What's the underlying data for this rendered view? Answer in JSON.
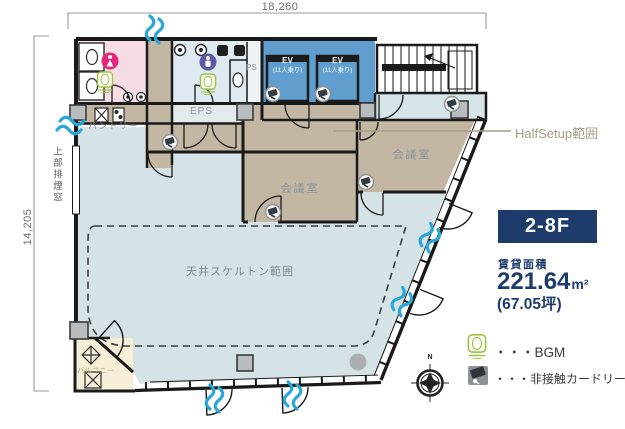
{
  "colors": {
    "accent_navy": "#1d3c6c",
    "halfsetup_tan": "#c3b7a4",
    "main_floor_blue": "#d6e3e6",
    "ev_blue": "#5f9ecf",
    "wc_women_pink": "#f6dde4",
    "wc_men_blue": "#dfeaf0",
    "eps_room": "#e2eaec",
    "hall_strip": "#d8e5e8",
    "balcony_cream": "#f6efd7",
    "airflow_blue": "#29a7d8",
    "bgm_green": "#9cc43e",
    "wall_black": "#1a1a1a"
  },
  "dimensions": {
    "width_mm": "18,260",
    "height_mm": "14,205"
  },
  "plan": {
    "rooms": {
      "pantry": "パントリー",
      "eps": "EPS",
      "ps": "PS",
      "meeting_room_center": "会議室",
      "meeting_room_right": "会議室",
      "skeleton_area": "天井スケルトン範囲",
      "balcony": "バルコニー",
      "smoke_window": "上部排煙窓"
    },
    "elevator": {
      "name": "EV",
      "capacity": "(11人乗り)"
    },
    "halfsetup_label": "HalfSetup範囲",
    "compass_north": "N"
  },
  "info": {
    "floor_badge": "2-8F",
    "area_label": "賃貸面積",
    "area_value": "221.64",
    "area_unit": "m²",
    "area_tsubo": "(67.05坪)",
    "legend": [
      {
        "icon": "bgm-speaker-icon",
        "label": "・・・BGM"
      },
      {
        "icon": "card-reader-icon",
        "label": "・・・非接触カードリーダー"
      }
    ]
  }
}
